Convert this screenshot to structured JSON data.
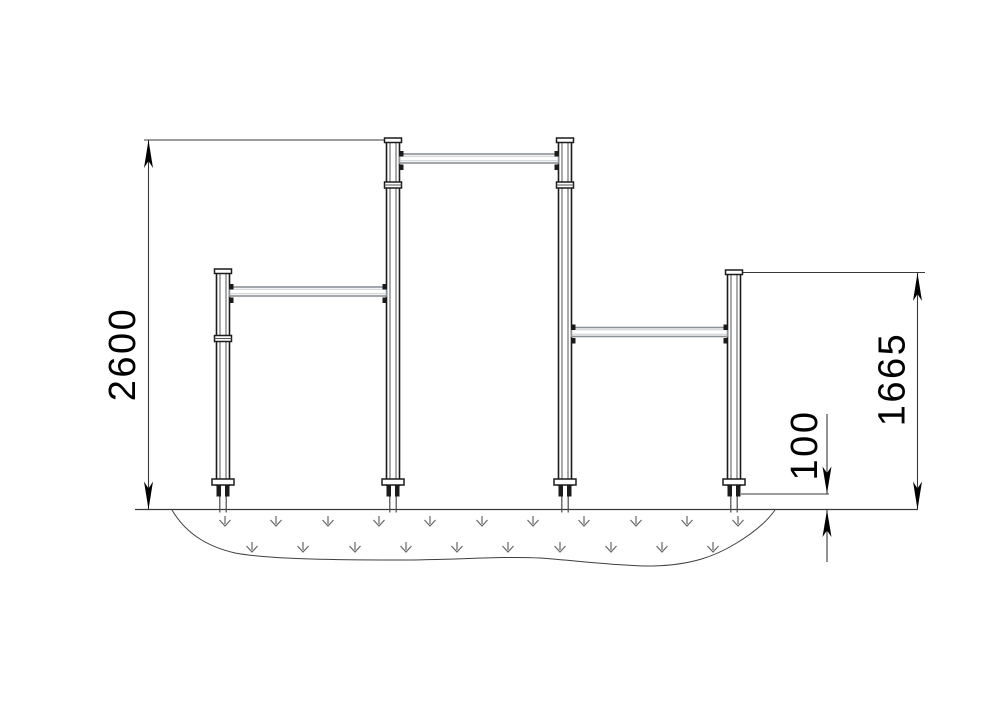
{
  "drawing": {
    "kind": "technical-elevation-drawing",
    "subject": "street-workout pull-up bar structure with four posts, three bars and safety surfacing",
    "dimensions": {
      "overall_height_mm": "2600",
      "low_bar_post_height_mm": "1665",
      "surfacing_depth_mm": "100"
    },
    "structure": {
      "posts": 4,
      "horizontal_bars": 3,
      "surfacing_symbol_rows": 2,
      "surfacing_symbols_row1": 11,
      "surfacing_symbols_row2": 10
    },
    "colors": {
      "background": "#ffffff",
      "structure_line": "#1c1c1c",
      "bar_line": "#8a9197",
      "dimension_line": "#3a3a3a",
      "surfacing_symbol": "#666666",
      "text": "#000000"
    }
  }
}
